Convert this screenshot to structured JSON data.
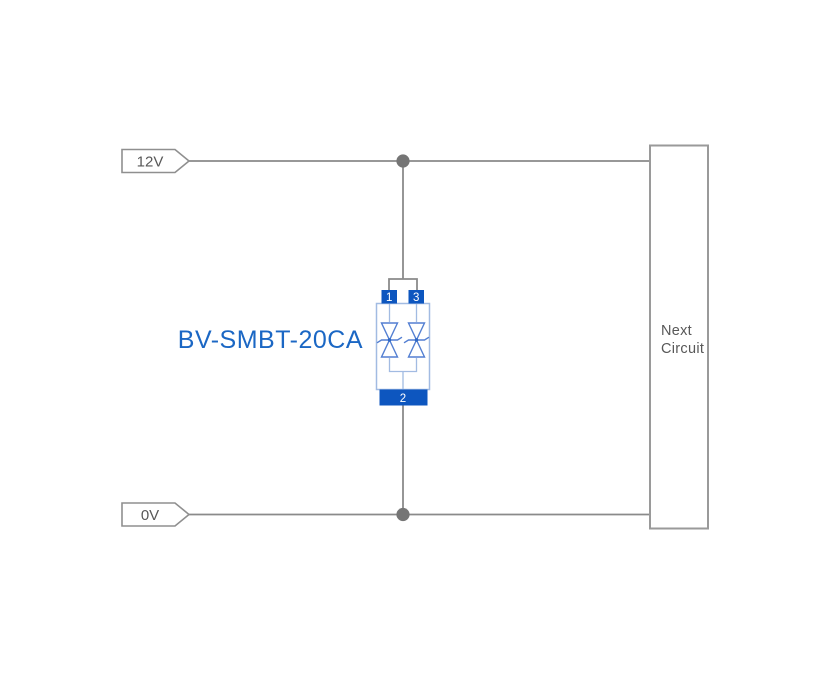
{
  "colors": {
    "wire": "#8a8a8a",
    "junction": "#757575",
    "outline_gray": "#8f8f8f",
    "label_gray": "#585858",
    "component_blue": "#1b67c4",
    "pin_blue": "#0d56bf",
    "body_blue": "#a2bbe2",
    "diode_blue": "#537fd2",
    "background": "#ffffff"
  },
  "rails": {
    "top": {
      "label": "12V"
    },
    "bottom": {
      "label": "0V"
    }
  },
  "component": {
    "label": "BV-SMBT-20CA",
    "pin_top_left": "1",
    "pin_top_right": "3",
    "pin_bottom": "2"
  },
  "next_circuit": {
    "line1": "Next",
    "line2": "Circuit"
  }
}
